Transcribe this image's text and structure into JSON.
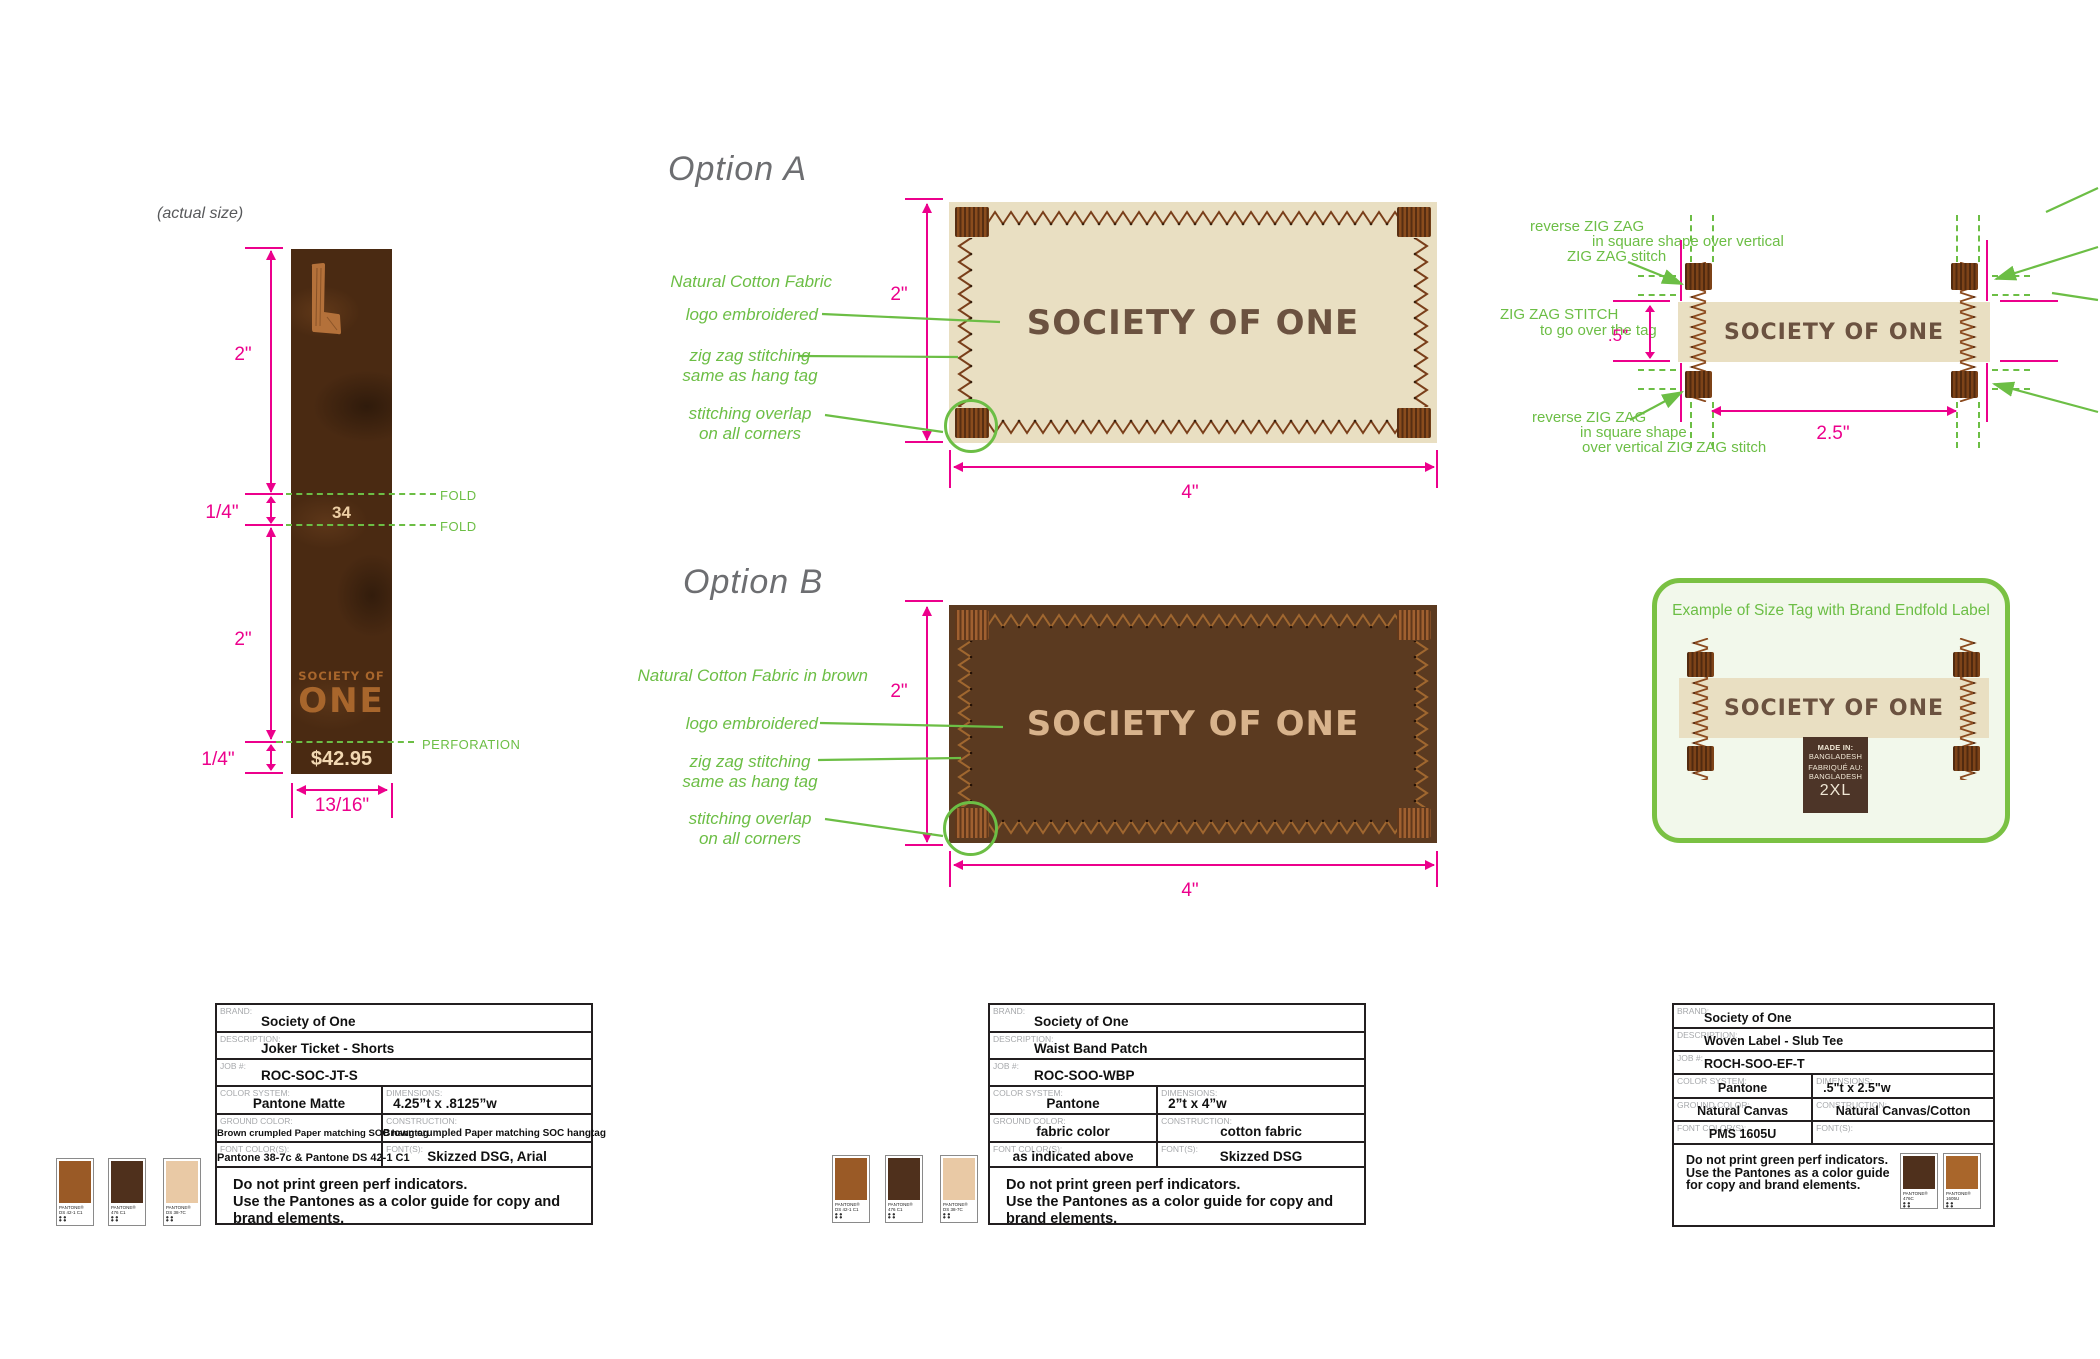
{
  "colors": {
    "pink": "#EC008C",
    "green": "#6CBE45",
    "box_green": "#7AC143",
    "heading_gray": "#6D6E71",
    "cream_fabric": "#E9DFC2",
    "brown_fabric": "#5B3A20",
    "hangtag_brown": "#4A2A12",
    "stitch_brown": "#7A3F1A",
    "stitch_light": "#A0672F",
    "logo_dark": "#6B5240",
    "logo_tan": "#D8B38C"
  },
  "hangtag": {
    "actual_size_note": "(actual size)",
    "fold_label_1": "FOLD",
    "fold_label_2": "FOLD",
    "perforation_label": "PERFORATION",
    "size_number": "34",
    "brand_top": "SOCIETY OF",
    "brand_bottom": "ONE",
    "price": "$42.95",
    "dim_top": "2\"",
    "dim_fold": "1/4\"",
    "dim_bottom": "2\"",
    "dim_perf": "1/4\"",
    "dim_width": "13/16\""
  },
  "option_a": {
    "heading": "Option A",
    "ann_fabric": "Natural Cotton Fabric",
    "ann_logo": "logo embroidered",
    "ann_stitch_1": "zig zag stitching",
    "ann_stitch_2": "same as hang tag",
    "ann_overlap_1": "stitching overlap",
    "ann_overlap_2": "on all corners",
    "label_text": "SOCIETY OF ONE",
    "dim_height": "2\"",
    "dim_width": "4\""
  },
  "option_b": {
    "heading": "Option B",
    "ann_fabric": "Natural Cotton Fabric in brown",
    "ann_logo": "logo embroidered",
    "ann_stitch_1": "zig zag stitching",
    "ann_stitch_2": "same as hang tag",
    "ann_overlap_1": "stitching overlap",
    "ann_overlap_2": "on all corners",
    "label_text": "SOCIETY OF ONE",
    "dim_height": "2\"",
    "dim_width": "4\""
  },
  "detail": {
    "ann_top_1": "reverse ZIG ZAG",
    "ann_top_2": "in square shape over vertical",
    "ann_top_3": "ZIG ZAG stitch",
    "ann_left_1": "ZIG ZAG STITCH",
    "ann_left_2": "to go over the tag",
    "ann_bottom_1": "reverse ZIG ZAG",
    "ann_bottom_2": "in square shape",
    "ann_bottom_3": "over vertical ZIG ZAG stitch",
    "label_text": "SOCIETY OF ONE",
    "dim_height": ".5\"",
    "dim_width": "2.5\""
  },
  "example_box": {
    "title": "Example of Size Tag with Brand Endfold Label",
    "label_text": "SOCIETY OF ONE",
    "size_tag": {
      "line1": "MADE IN:",
      "line2": "BANGLADESH",
      "line3": "FABRIQUÉ AU:",
      "line4": "BANGLADESH",
      "size": "2XL"
    }
  },
  "spec_tables": [
    {
      "brand_label": "BRAND:",
      "brand": "Society of One",
      "description_label": "DESCRIPTION:",
      "description": "Joker Ticket - Shorts",
      "job_label": "JOB #:",
      "job": "ROC-SOC-JT-S",
      "color_system_label": "COLOR SYSTEM:",
      "color_system": "Pantone Matte",
      "dimensions_label": "DIMENSIONS:",
      "dimensions": "4.25”t x .8125”w",
      "ground_label": "GROUND COLOR:",
      "ground": "Brown crumpled Paper matching SOC hangtag",
      "construction_label": "CONSTRUCTION:",
      "construction": "Brown crumpled  Paper matching SOC hangtag",
      "font_colors_label": "FONT COLOR(S):",
      "font_colors": "Pantone 38-7c & Pantone DS 42-1 C1",
      "fonts_label": "FONT(S):",
      "fonts": "Skizzed DSG, Arial",
      "note_line1": "Do not print green perf indicators.",
      "note_line2": "Use the Pantones as a color guide for copy and brand elements."
    },
    {
      "brand_label": "BRAND:",
      "brand": "Society of One",
      "description_label": "DESCRIPTION:",
      "description": "Waist Band Patch",
      "job_label": "JOB #:",
      "job": "ROC-SOO-WBP",
      "color_system_label": "COLOR SYSTEM:",
      "color_system": "Pantone",
      "dimensions_label": "DIMENSIONS:",
      "dimensions": "2”t x 4”w",
      "ground_label": "GROUND COLOR:",
      "ground": "fabric color",
      "construction_label": "CONSTRUCTION:",
      "construction": "cotton fabric",
      "font_colors_label": "FONT COLOR(S):",
      "font_colors": "as indicated above",
      "fonts_label": "FONT(S):",
      "fonts": "Skizzed DSG",
      "note_line1": "Do not print green perf indicators.",
      "note_line2": "Use the Pantones as a color guide for copy and brand elements."
    },
    {
      "brand_label": "BRAND:",
      "brand": "Society of One",
      "description_label": "DESCRIPTION:",
      "description": "Woven Label - Slub Tee",
      "job_label": "JOB #:",
      "job": "ROCH-SOO-EF-T",
      "color_system_label": "COLOR SYSTEM:",
      "color_system": "Pantone",
      "dimensions_label": "DIMENSIONS:",
      "dimensions": ".5\"t x 2.5\"w",
      "ground_label": "GROUND COLOR:",
      "ground": "Natural Canvas",
      "construction_label": "CONSTRUCTION:",
      "construction": "Natural Canvas/Cotton",
      "font_colors_label": "FONT COLOR(S):",
      "font_colors": "PMS  1605U",
      "fonts_label": "FONT(S):",
      "fonts": "",
      "note_line1": "Do not print green perf indicators.",
      "note_line2": "Use the Pantones as a color guide",
      "note_line3": "for copy and brand elements."
    }
  ],
  "swatches": {
    "group1": [
      {
        "name": "PANTONE®",
        "code": "DS 42-1 C1",
        "color": "#9A5A26"
      },
      {
        "name": "PANTONE®",
        "code": "476 C1",
        "color": "#4F301C"
      },
      {
        "name": "PANTONE®",
        "code": "DS 38-7C",
        "color": "#E9C9A5"
      }
    ],
    "group2": [
      {
        "name": "PANTONE®",
        "code": "DS 42-1 C1",
        "color": "#9A5A26"
      },
      {
        "name": "PANTONE®",
        "code": "476 C1",
        "color": "#4F301C"
      },
      {
        "name": "PANTONE®",
        "code": "DS 38-7C",
        "color": "#E9C9A5"
      }
    ],
    "group3": [
      {
        "name": "PANTONE®",
        "code": "476C",
        "color": "#4F301C"
      },
      {
        "name": "PANTONE®",
        "code": "1605U",
        "color": "#A9662B"
      }
    ]
  }
}
